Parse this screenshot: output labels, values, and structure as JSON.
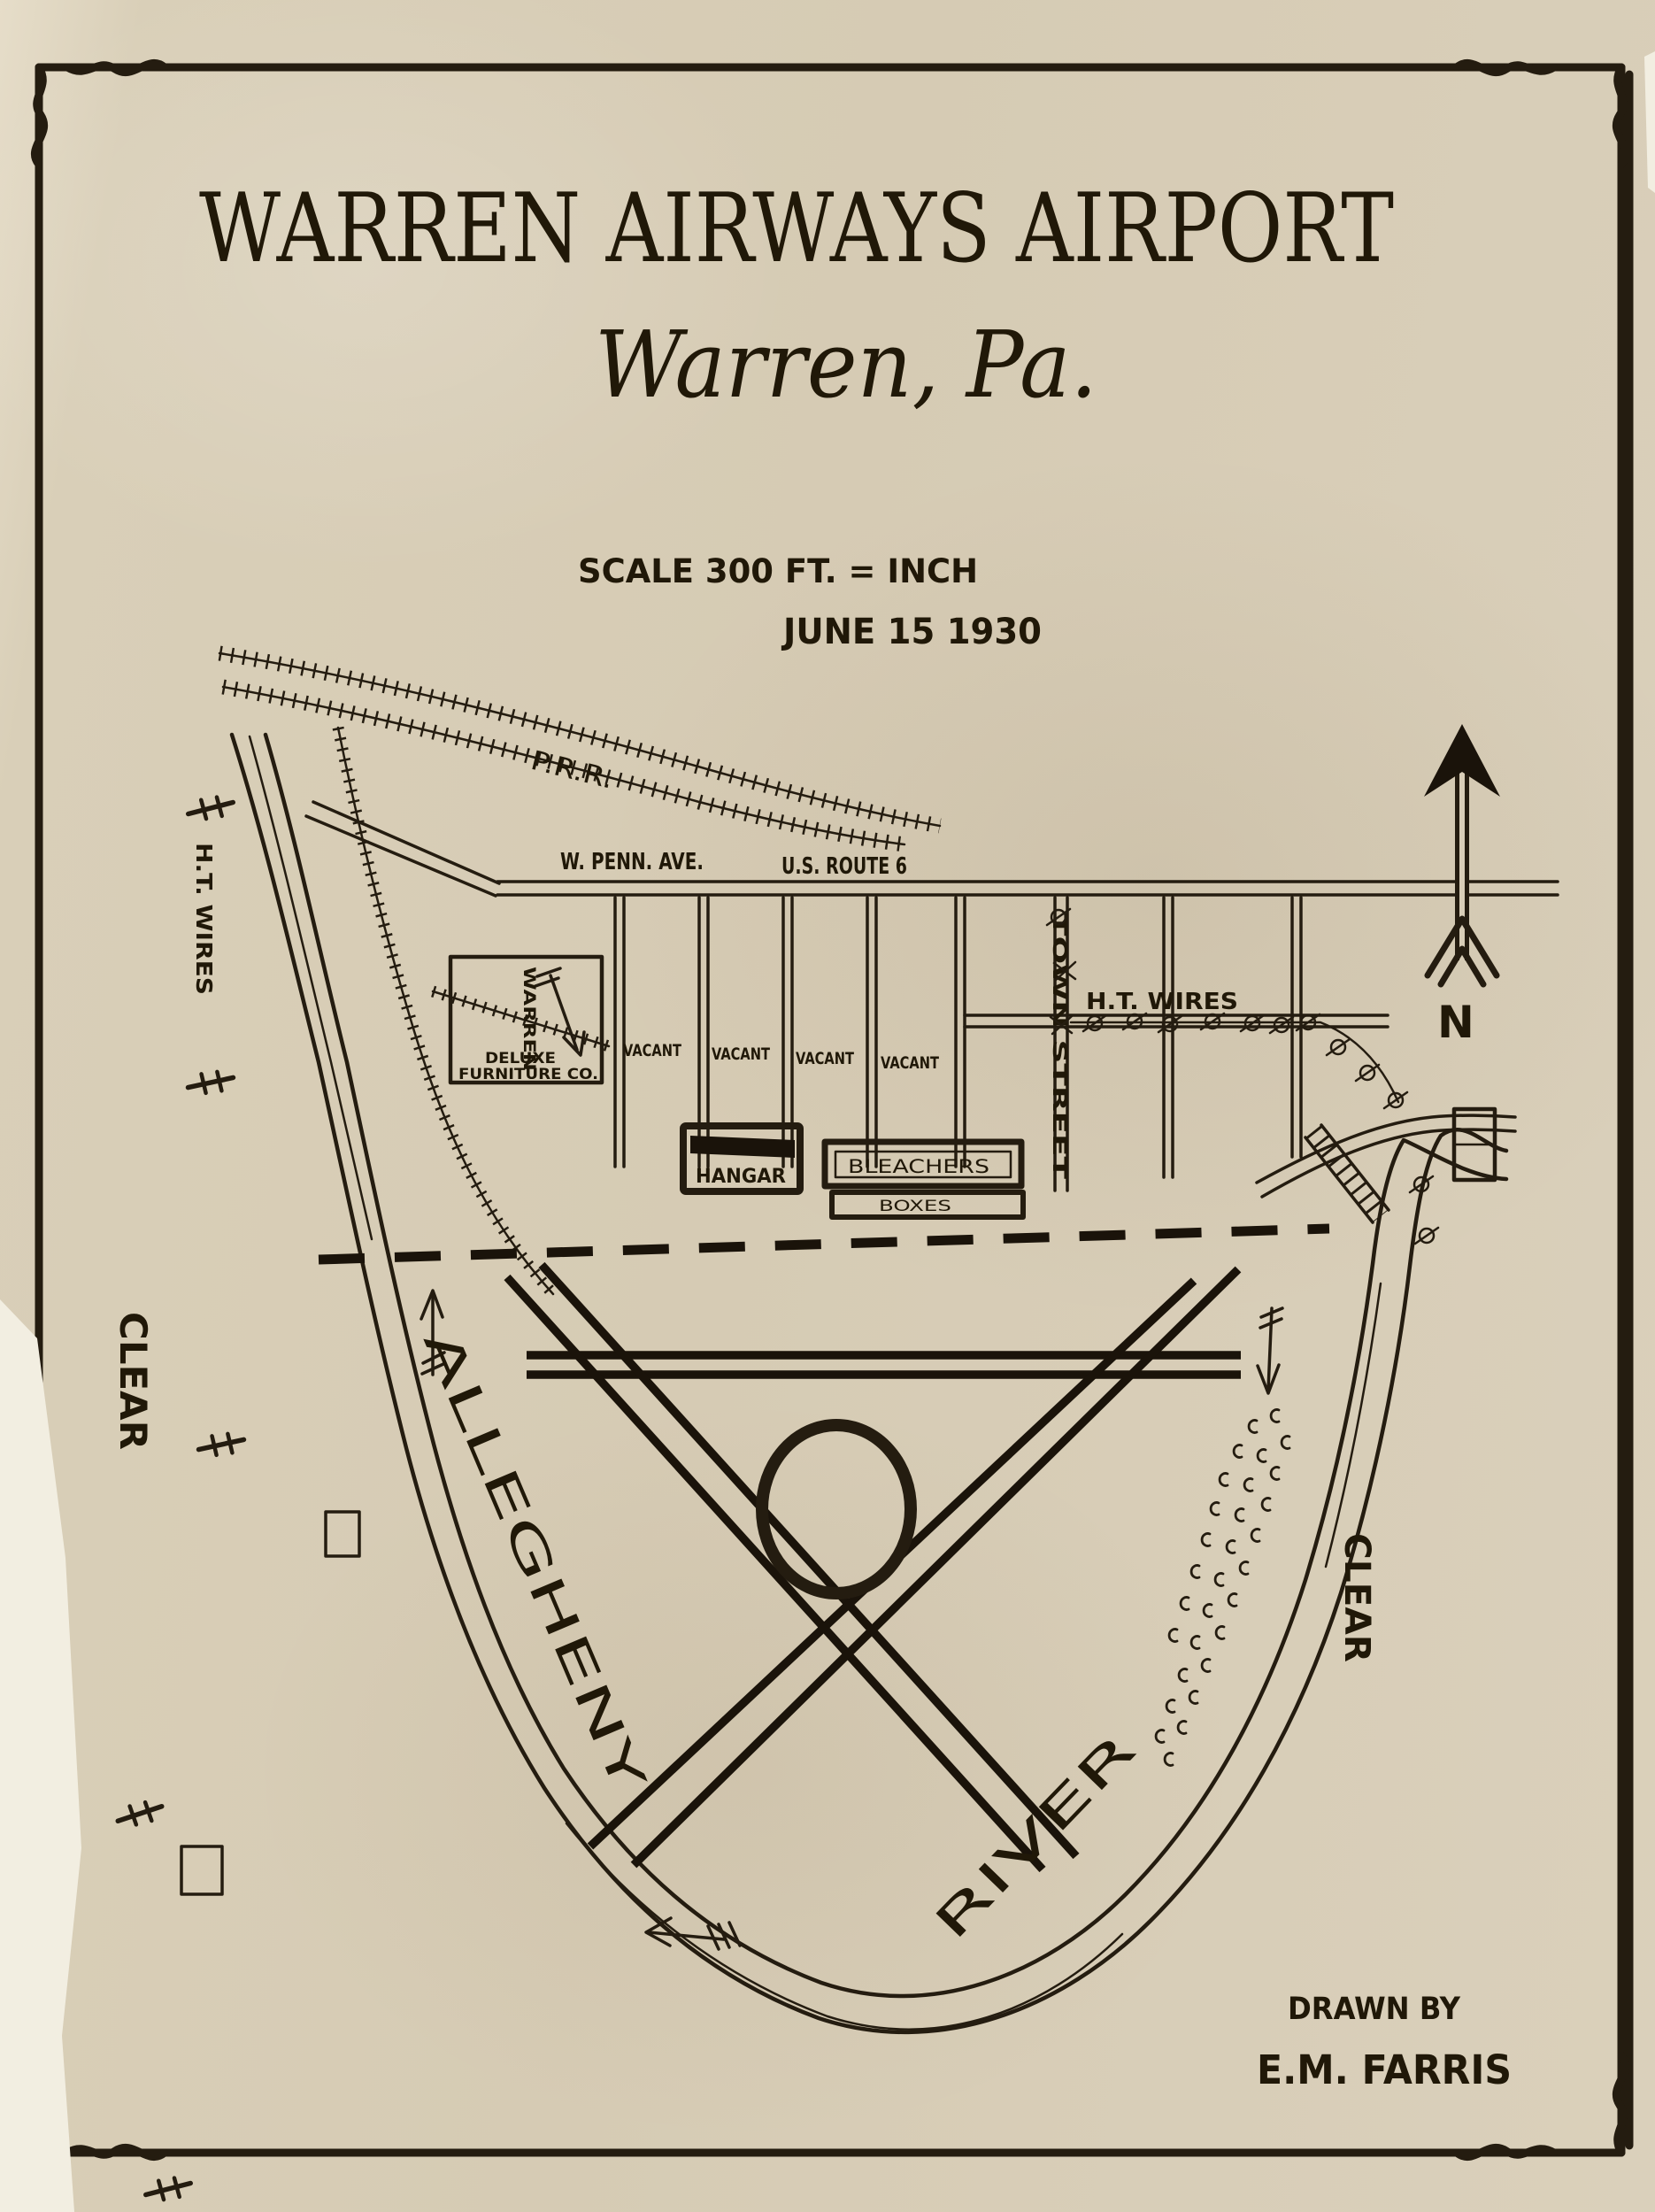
{
  "page": {
    "title": "WARREN AIRWAYS AIRPORT",
    "subtitle": "Warren, Pa.",
    "scale_note": "SCALE 300 FT. = INCH",
    "date": "JUNE 15 1930",
    "credit_line1": "DRAWN BY",
    "credit_line2": "E.M. FARRIS",
    "north_label": "N"
  },
  "roads": {
    "avenue": "W. PENN. AVE.",
    "route": "U.S. ROUTE 6",
    "town_street": "TOWN STREET"
  },
  "railroad": {
    "label": "P.R.R."
  },
  "river": {
    "name_upper": "ALLEGHENY",
    "name_lower": "RIVER"
  },
  "utilities": {
    "ht_wires_left": "H.T. WIRES",
    "ht_wires_right": "H.T. WIRES"
  },
  "zones": {
    "clear_left": "CLEAR",
    "clear_right": "CLEAR",
    "vacant": [
      "VACANT",
      "VACANT",
      "VACANT",
      "VACANT"
    ]
  },
  "buildings": {
    "hangar": "HANGAR",
    "bleachers": "BLEACHERS",
    "boxes": "BOXES",
    "furniture_vertical": "WARREN",
    "furniture_line1": "DELUXE",
    "furniture_line2": "FURNITURE CO."
  },
  "colors": {
    "paper": "#d8cdb7",
    "ink": "#241c10"
  }
}
